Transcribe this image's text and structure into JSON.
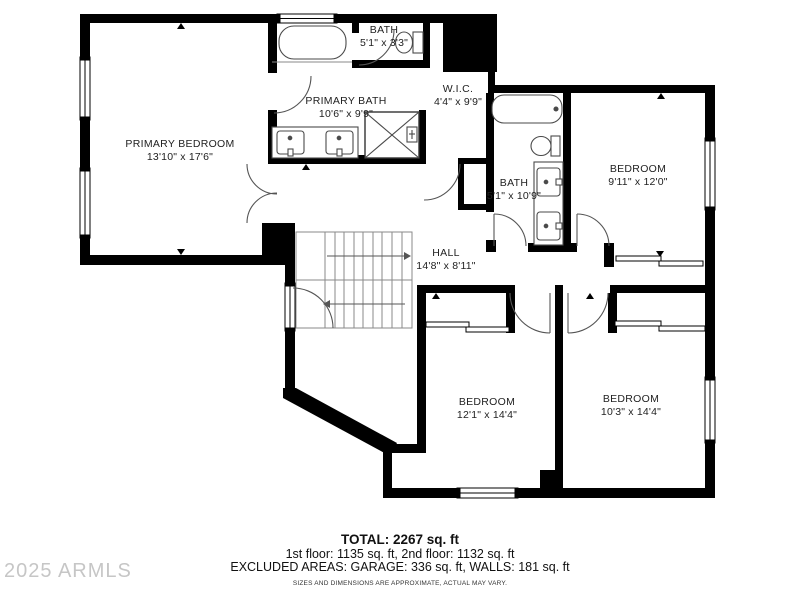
{
  "colors": {
    "wall": "#000000",
    "background": "#ffffff",
    "fixture_line": "#4a4a4a",
    "stair_line": "#8a8a8a",
    "label_text": "#222222",
    "watermark": "#c6c6c6"
  },
  "watermark": {
    "text": "2025 ARMLS"
  },
  "rooms": {
    "primary_bedroom": {
      "name": "PRIMARY BEDROOM",
      "dims": "13'10\" x 17'6\""
    },
    "primary_bath": {
      "name": "PRIMARY BATH",
      "dims": "10'6\" x 9'9\""
    },
    "bath_top": {
      "name": "BATH",
      "dims": "5'1\" x 3'3\""
    },
    "wic": {
      "name": "W.I.C.",
      "dims": "4'4\" x 9'9\""
    },
    "bath_right": {
      "name": "BATH",
      "dims": "5'1\" x 10'9\""
    },
    "bedroom_top_right": {
      "name": "BEDROOM",
      "dims": "9'11\" x 12'0\""
    },
    "hall": {
      "name": "HALL",
      "dims": "14'8\" x 8'11\""
    },
    "bedroom_bottom_left": {
      "name": "BEDROOM",
      "dims": "12'1\" x 14'4\""
    },
    "bedroom_bottom_right": {
      "name": "BEDROOM",
      "dims": "10'3\" x 14'4\""
    }
  },
  "footer": {
    "total": "TOTAL: 2267 sq. ft",
    "floors": "1st floor: 1135 sq. ft, 2nd floor: 1132 sq. ft",
    "excluded": "EXCLUDED AREAS: GARAGE: 336 sq. ft, WALLS: 181 sq. ft",
    "disclaimer": "SIZES AND DIMENSIONS ARE APPROXIMATE, ACTUAL MAY VARY."
  }
}
